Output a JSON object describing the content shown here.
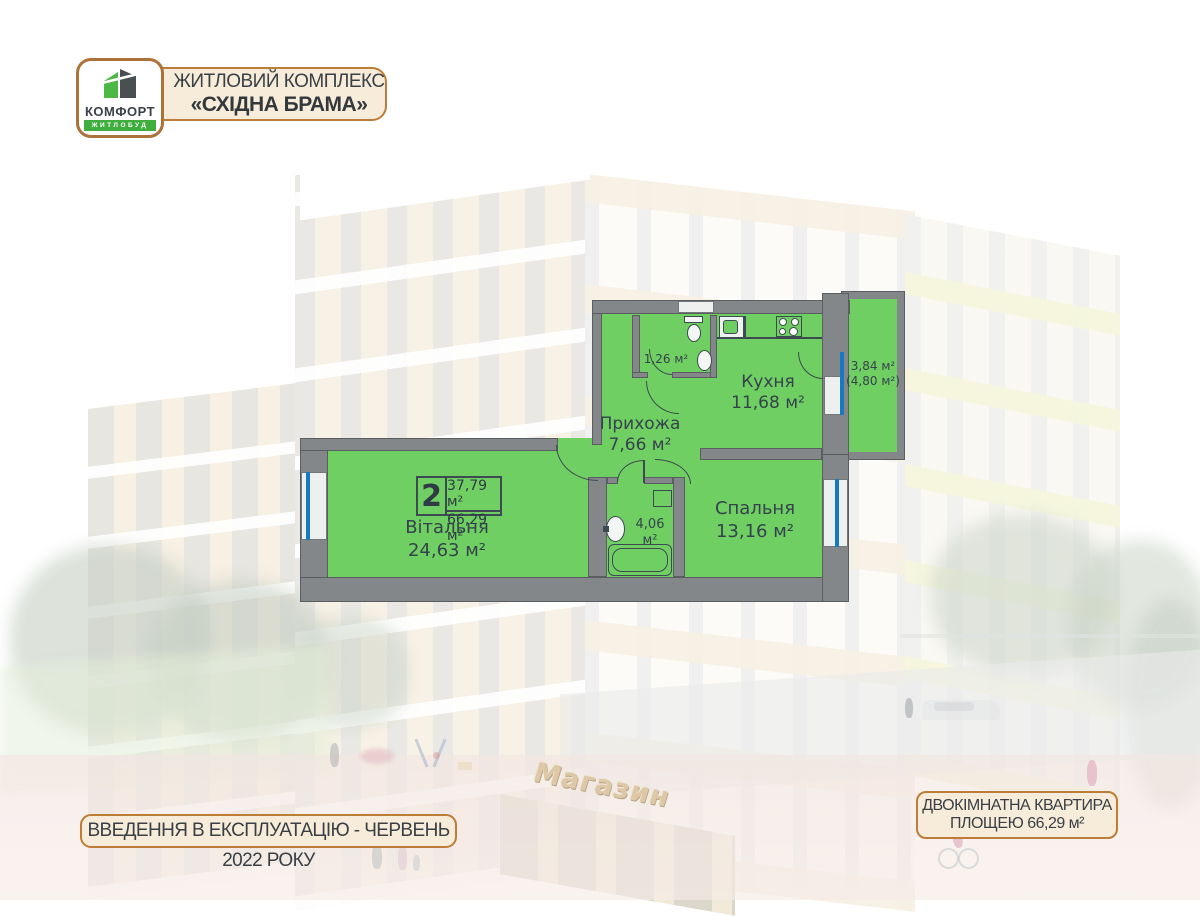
{
  "header": {
    "logo": {
      "brand": "КОМФОРТ",
      "sub": "ЖИТЛОБУД"
    },
    "complex_badge": {
      "line1": "ЖИТЛОВИЙ КОМПЛЕКС",
      "line2": "«СХІДНА БРАМА»"
    }
  },
  "plan": {
    "unit_number": "2",
    "living_area_sum": "37,79 м²",
    "total_area": "66,29 м²",
    "rooms": {
      "living": {
        "name": "Вітальня",
        "area": "24,63 м²"
      },
      "hallway": {
        "name": "Прихожа",
        "area": "7,66 м²"
      },
      "kitchen": {
        "name": "Кухня",
        "area": "11,68 м²"
      },
      "bedroom": {
        "name": "Спальня",
        "area": "13,16 м²"
      },
      "bathroom": {
        "area": "4,06 м²"
      },
      "wc": {
        "area": "1,26 м²"
      },
      "balcony": {
        "area": "3,84 м²",
        "area_full": "(4,80 м²)"
      }
    }
  },
  "background": {
    "shop_sign": "Магазин"
  },
  "footer": {
    "commissioning_badge": "ВВЕДЕННЯ В ЕКСПЛУАТАЦІЮ - ЧЕРВЕНЬ 2022 РОКУ",
    "apartment_badge": {
      "line1": "ДВОКІМНАТНА КВАРТИРА",
      "line2": "ПЛОЩЕЮ 66,29 м²"
    }
  },
  "colors": {
    "plan_green": "#70cf62",
    "wall_gray": "#84878a",
    "window_blue": "#1779c0",
    "badge_cream": "#f6ecd9",
    "badge_border": "#bd7c37",
    "logo_green": "#3fae3f",
    "text_dark": "#35424d"
  }
}
